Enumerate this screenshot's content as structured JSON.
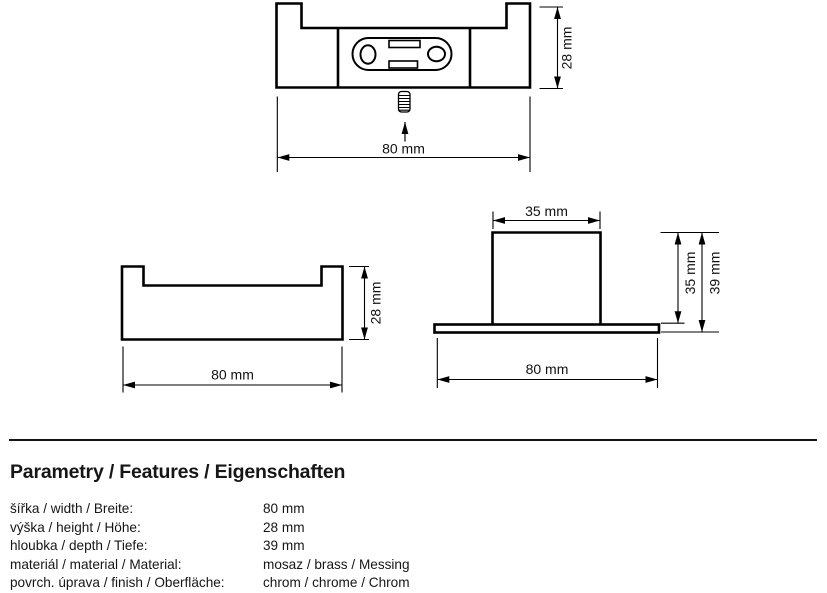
{
  "drawing": {
    "top_view": {
      "width_dim": "80 mm",
      "height_dim": "28 mm"
    },
    "front_view": {
      "width_dim": "80 mm",
      "height_dim": "28 mm"
    },
    "side_view": {
      "block_width_dim": "35 mm",
      "block_height_dim": "35 mm",
      "overall_depth_dim": "39 mm",
      "base_width_dim": "80 mm"
    }
  },
  "specs": {
    "heading": "Parametry / Features / Eigenschaften",
    "rows": [
      {
        "label": "šířka / width / Breite:",
        "value": "80 mm"
      },
      {
        "label": "výška / height / Höhe:",
        "value": "28 mm"
      },
      {
        "label": "hloubka / depth / Tiefe:",
        "value": "39 mm"
      },
      {
        "label": "materiál / material / Material:",
        "value": "mosaz / brass / Messing"
      },
      {
        "label": "povrch. úprava / finish / Oberfläche:",
        "value": "chrom / chrome / Chrom"
      }
    ]
  },
  "colors": {
    "line": "#000000",
    "text": "#161616"
  }
}
